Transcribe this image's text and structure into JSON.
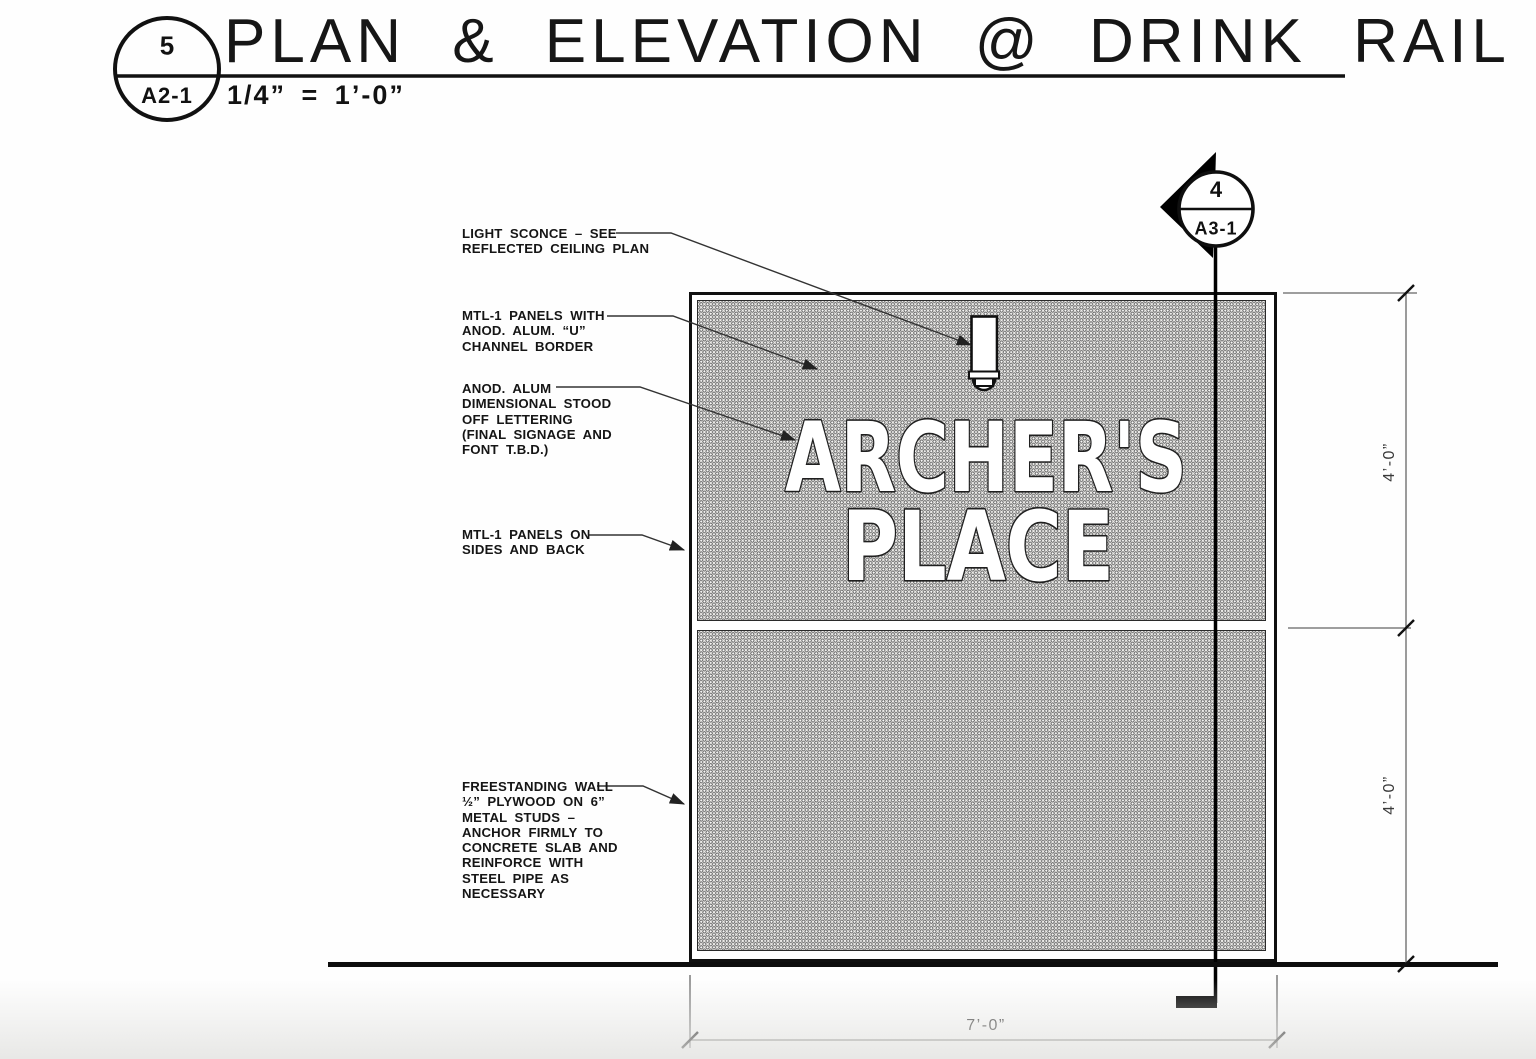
{
  "header": {
    "detail_number": "5",
    "detail_sheet": "A2-1",
    "title": "PLAN & ELEVATION @ DRINK RAIL",
    "scale": "1/4” = 1’-0”"
  },
  "section_marker": {
    "number": "4",
    "sheet": "A3-1"
  },
  "annotations": [
    {
      "id": "light-sconce",
      "lines": [
        "LIGHT SCONCE – SEE",
        "REFLECTED CEILING PLAN"
      ]
    },
    {
      "id": "mtl1-panels-border",
      "lines": [
        "MTL-1 PANELS WITH",
        "ANOD. ALUM. “U”",
        "CHANNEL BORDER"
      ]
    },
    {
      "id": "stood-off-lettering",
      "lines": [
        "ANOD. ALUM",
        "DIMENSIONAL STOOD",
        "OFF LETTERING",
        "(FINAL SIGNAGE AND",
        "FONT T.B.D.)"
      ]
    },
    {
      "id": "mtl1-sides-back",
      "lines": [
        "MTL-1 PANELS ON",
        "SIDES AND BACK"
      ]
    },
    {
      "id": "freestanding-wall",
      "lines": [
        "FREESTANDING WALL",
        "½” PLYWOOD ON 6”",
        "METAL STUDS –",
        "ANCHOR FIRMLY TO",
        "CONCRETE SLAB AND",
        "REINFORCE WITH",
        "STEEL PIPE AS",
        "NECESSARY"
      ]
    }
  ],
  "sign": {
    "line1": "ARCHER'S",
    "line2": "PLACE"
  },
  "dimensions": {
    "upper_height": "4’-0”",
    "lower_height": "4’-0”",
    "width": "7’-0”"
  },
  "colors": {
    "ink": "#111111",
    "hatch_ring": "#6f6f6f",
    "hatch_bg": "#edece9"
  }
}
